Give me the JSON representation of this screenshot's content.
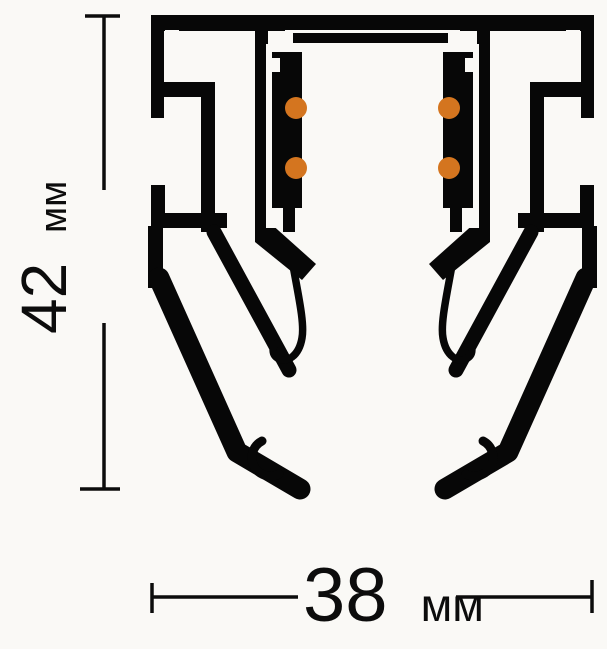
{
  "drawing": {
    "title": "track-profile-cross-section",
    "background_color": "#faf9f6",
    "profile_color": "#070707",
    "conductor_color": "#d4751f",
    "conductor_count": 4,
    "icons": {
      "profile_silhouette": "extrusion-cross-section-icon",
      "conductors": "conductor-dot-icon"
    }
  },
  "dimensions": {
    "height": {
      "value": "42",
      "unit": "мм",
      "label": "42 мм"
    },
    "width": {
      "value": "38",
      "unit": "мм",
      "label": "38 мм"
    }
  }
}
